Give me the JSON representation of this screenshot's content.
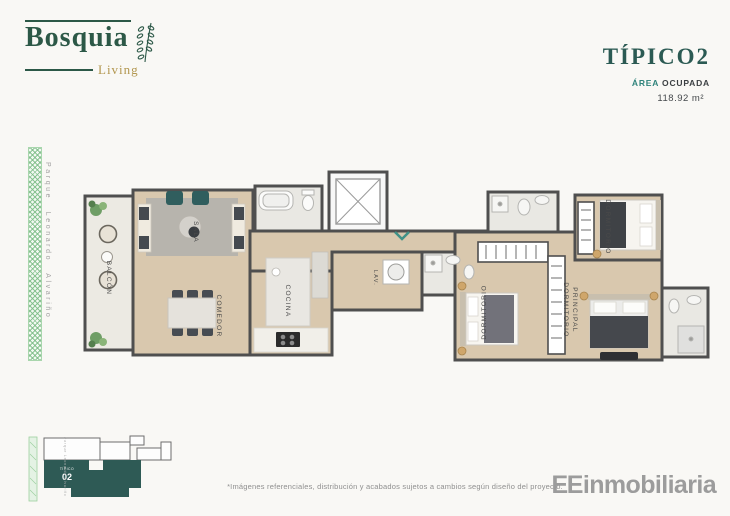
{
  "brand": {
    "name": "Bosquia",
    "tagline": "Living"
  },
  "header": {
    "unit_title": "TÍPICO2",
    "area_label_accent": "ÁREA",
    "area_label_rest": "OCUPADA",
    "area_value": "118.92 m²"
  },
  "street": {
    "name": "Parque Leonardo Alvariño"
  },
  "floorplan": {
    "rooms": [
      {
        "id": "balcon",
        "label": "BALCÓN"
      },
      {
        "id": "sala",
        "label": "SALA"
      },
      {
        "id": "comedor",
        "label": "COMEDOR"
      },
      {
        "id": "cocina",
        "label": "COCINA"
      },
      {
        "id": "lavanderia",
        "label": "LAV."
      },
      {
        "id": "dormitorio",
        "label": "DORMITORIO"
      },
      {
        "id": "dormitorio-2",
        "label": "DORMITORIO"
      },
      {
        "id": "dormitorio-principal",
        "label_lines": [
          "DORMITORIO",
          "PRINCIPAL"
        ]
      }
    ]
  },
  "keyplan": {
    "unit_label_small": "TÍPICO",
    "unit_label_big": "02",
    "street": "Parque Leonardo Alvariño"
  },
  "footer": {
    "disclaimer": "*Imágenes referenciales, distribución y acabados sujetos a cambios según diseño del proyecto.",
    "agency_bold": "EE",
    "agency_rest": "inmobiliaria"
  },
  "colors": {
    "brand_green": "#2c5847",
    "brand_gold": "#b2964e",
    "title_teal": "#2b5a53",
    "accent_teal": "#2f837b",
    "keyplan_teal": "#2e5a55",
    "wall_gray": "#4f4f4f",
    "wood_floor": "#d9c8ae",
    "tile_floor": "#e9e8e3",
    "pattern_green": "#7cbc86",
    "text_gray": "#8f8f8f"
  }
}
